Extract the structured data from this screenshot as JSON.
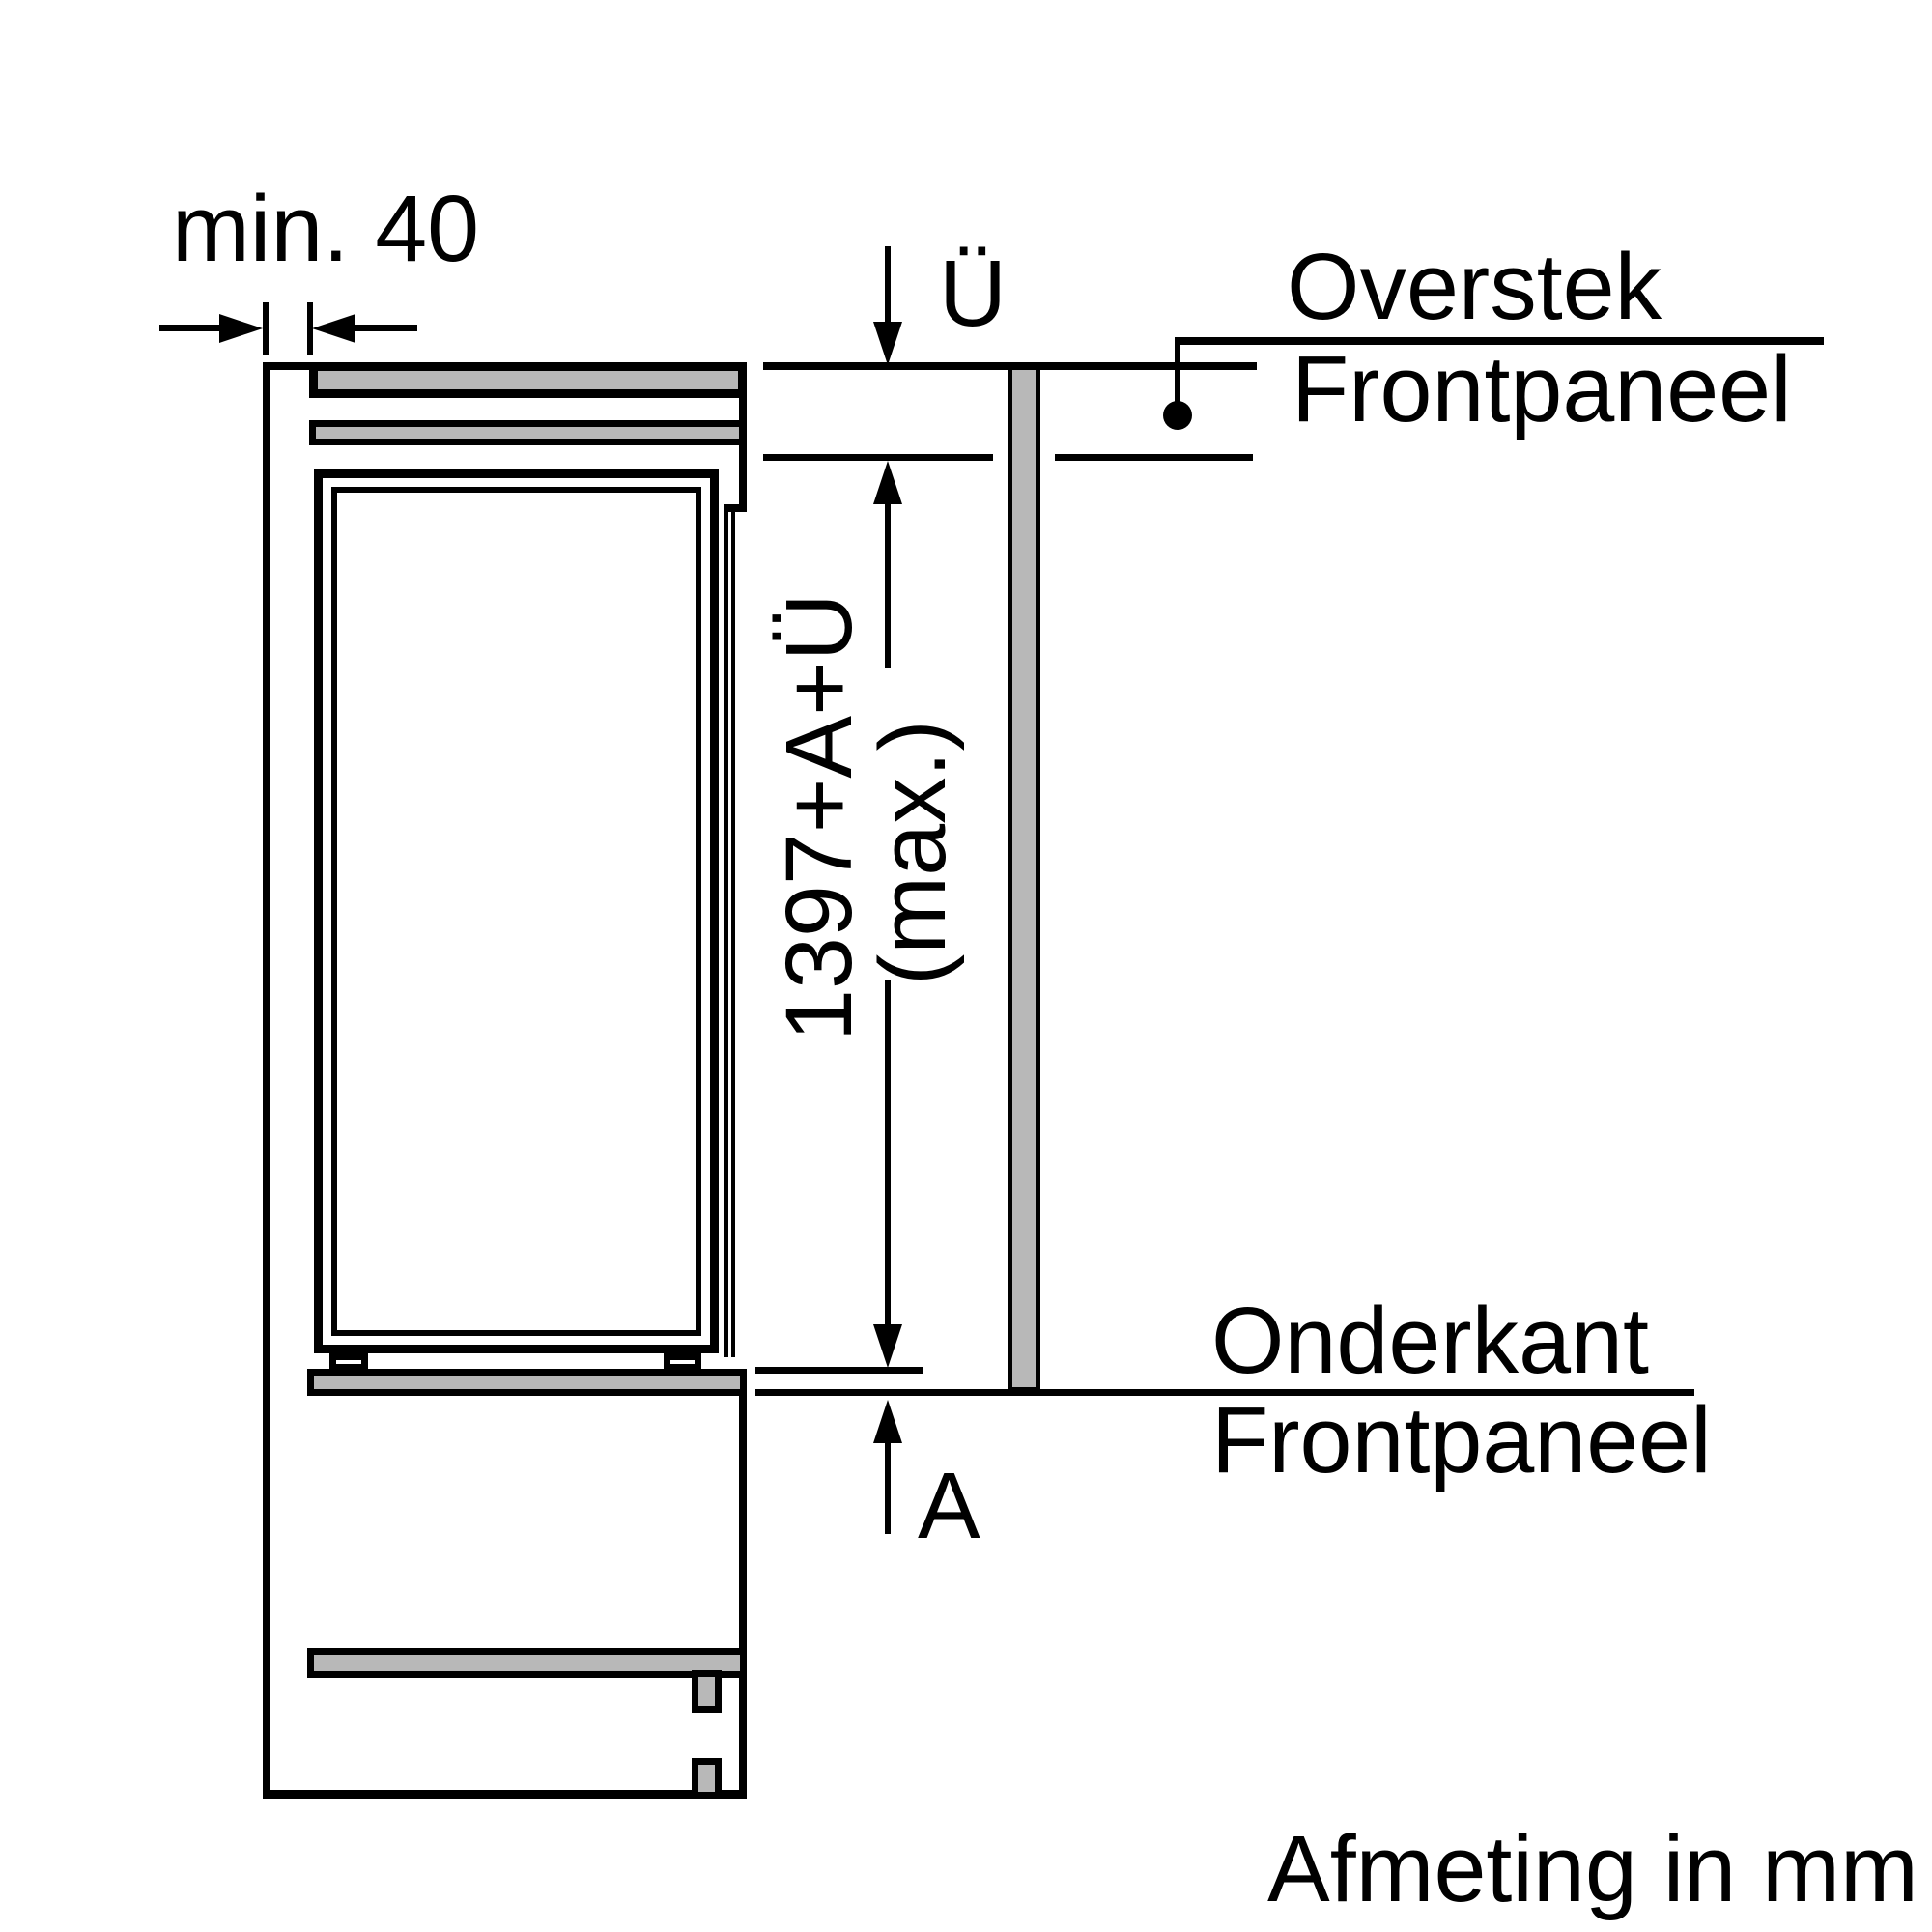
{
  "diagram": {
    "title": "built-in appliance niche side-view installation drawing",
    "labels": {
      "min_gap": "min. 40",
      "overhang_symbol": "Ü",
      "overstek": "Overstek",
      "frontpaneel_top": "Frontpaneel",
      "dimension_formula": "1397+A+Ü",
      "dimension_max": "(max.)",
      "onderkant": "Onderkant",
      "frontpaneel_bottom": "Frontpaneel",
      "bottom_gap_symbol": "A",
      "footer": "Afmeting in mm"
    },
    "dimensions": {
      "min_side_clearance_mm": "40",
      "panel_height_formula": "1397+A+Ü (max.)"
    },
    "colors": {
      "line": "#000000",
      "panel_fill": "#b8b8b8",
      "background": "#ffffff"
    }
  }
}
